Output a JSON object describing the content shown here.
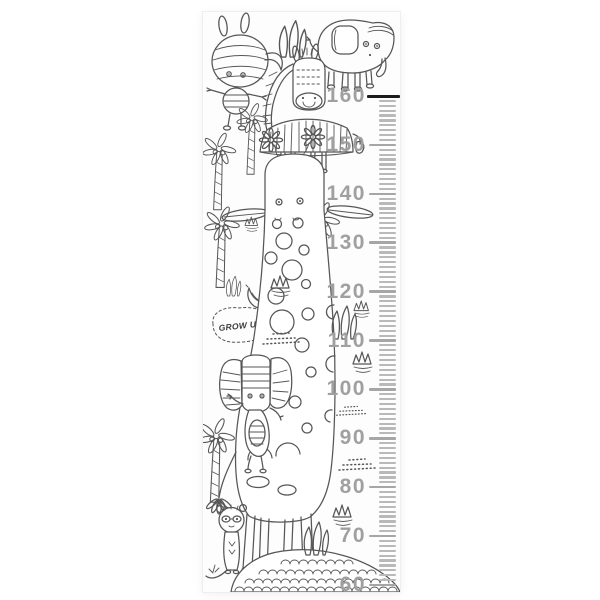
{
  "colors": {
    "page_bg": "#ffffff",
    "panel_bg": "#fdfdfd",
    "line_art": "#565656",
    "ruler_number": "#a0a0a0",
    "ruler_tick": "#a6a6a6",
    "ruler_tick_minor": "#b9b9b9",
    "ruler_tick_top": "#1c1c1c",
    "bubble_text": "#3c3c3c"
  },
  "ruler": {
    "numbers": [
      "160",
      "150",
      "140",
      "130",
      "120",
      "110",
      "100",
      "90",
      "80",
      "70",
      "60"
    ],
    "max": "160",
    "min": "60",
    "minor_ticks_between_majors": 9
  },
  "artwork": {
    "speech_bubble": {
      "text": "GROW UP!"
    },
    "motifs": [
      "rhinoceros",
      "elephant",
      "zebra",
      "giraffe",
      "circus elephant",
      "meerkat",
      "palm trees",
      "daisy flowers",
      "banana",
      "grass tufts",
      "pebble mound"
    ]
  }
}
